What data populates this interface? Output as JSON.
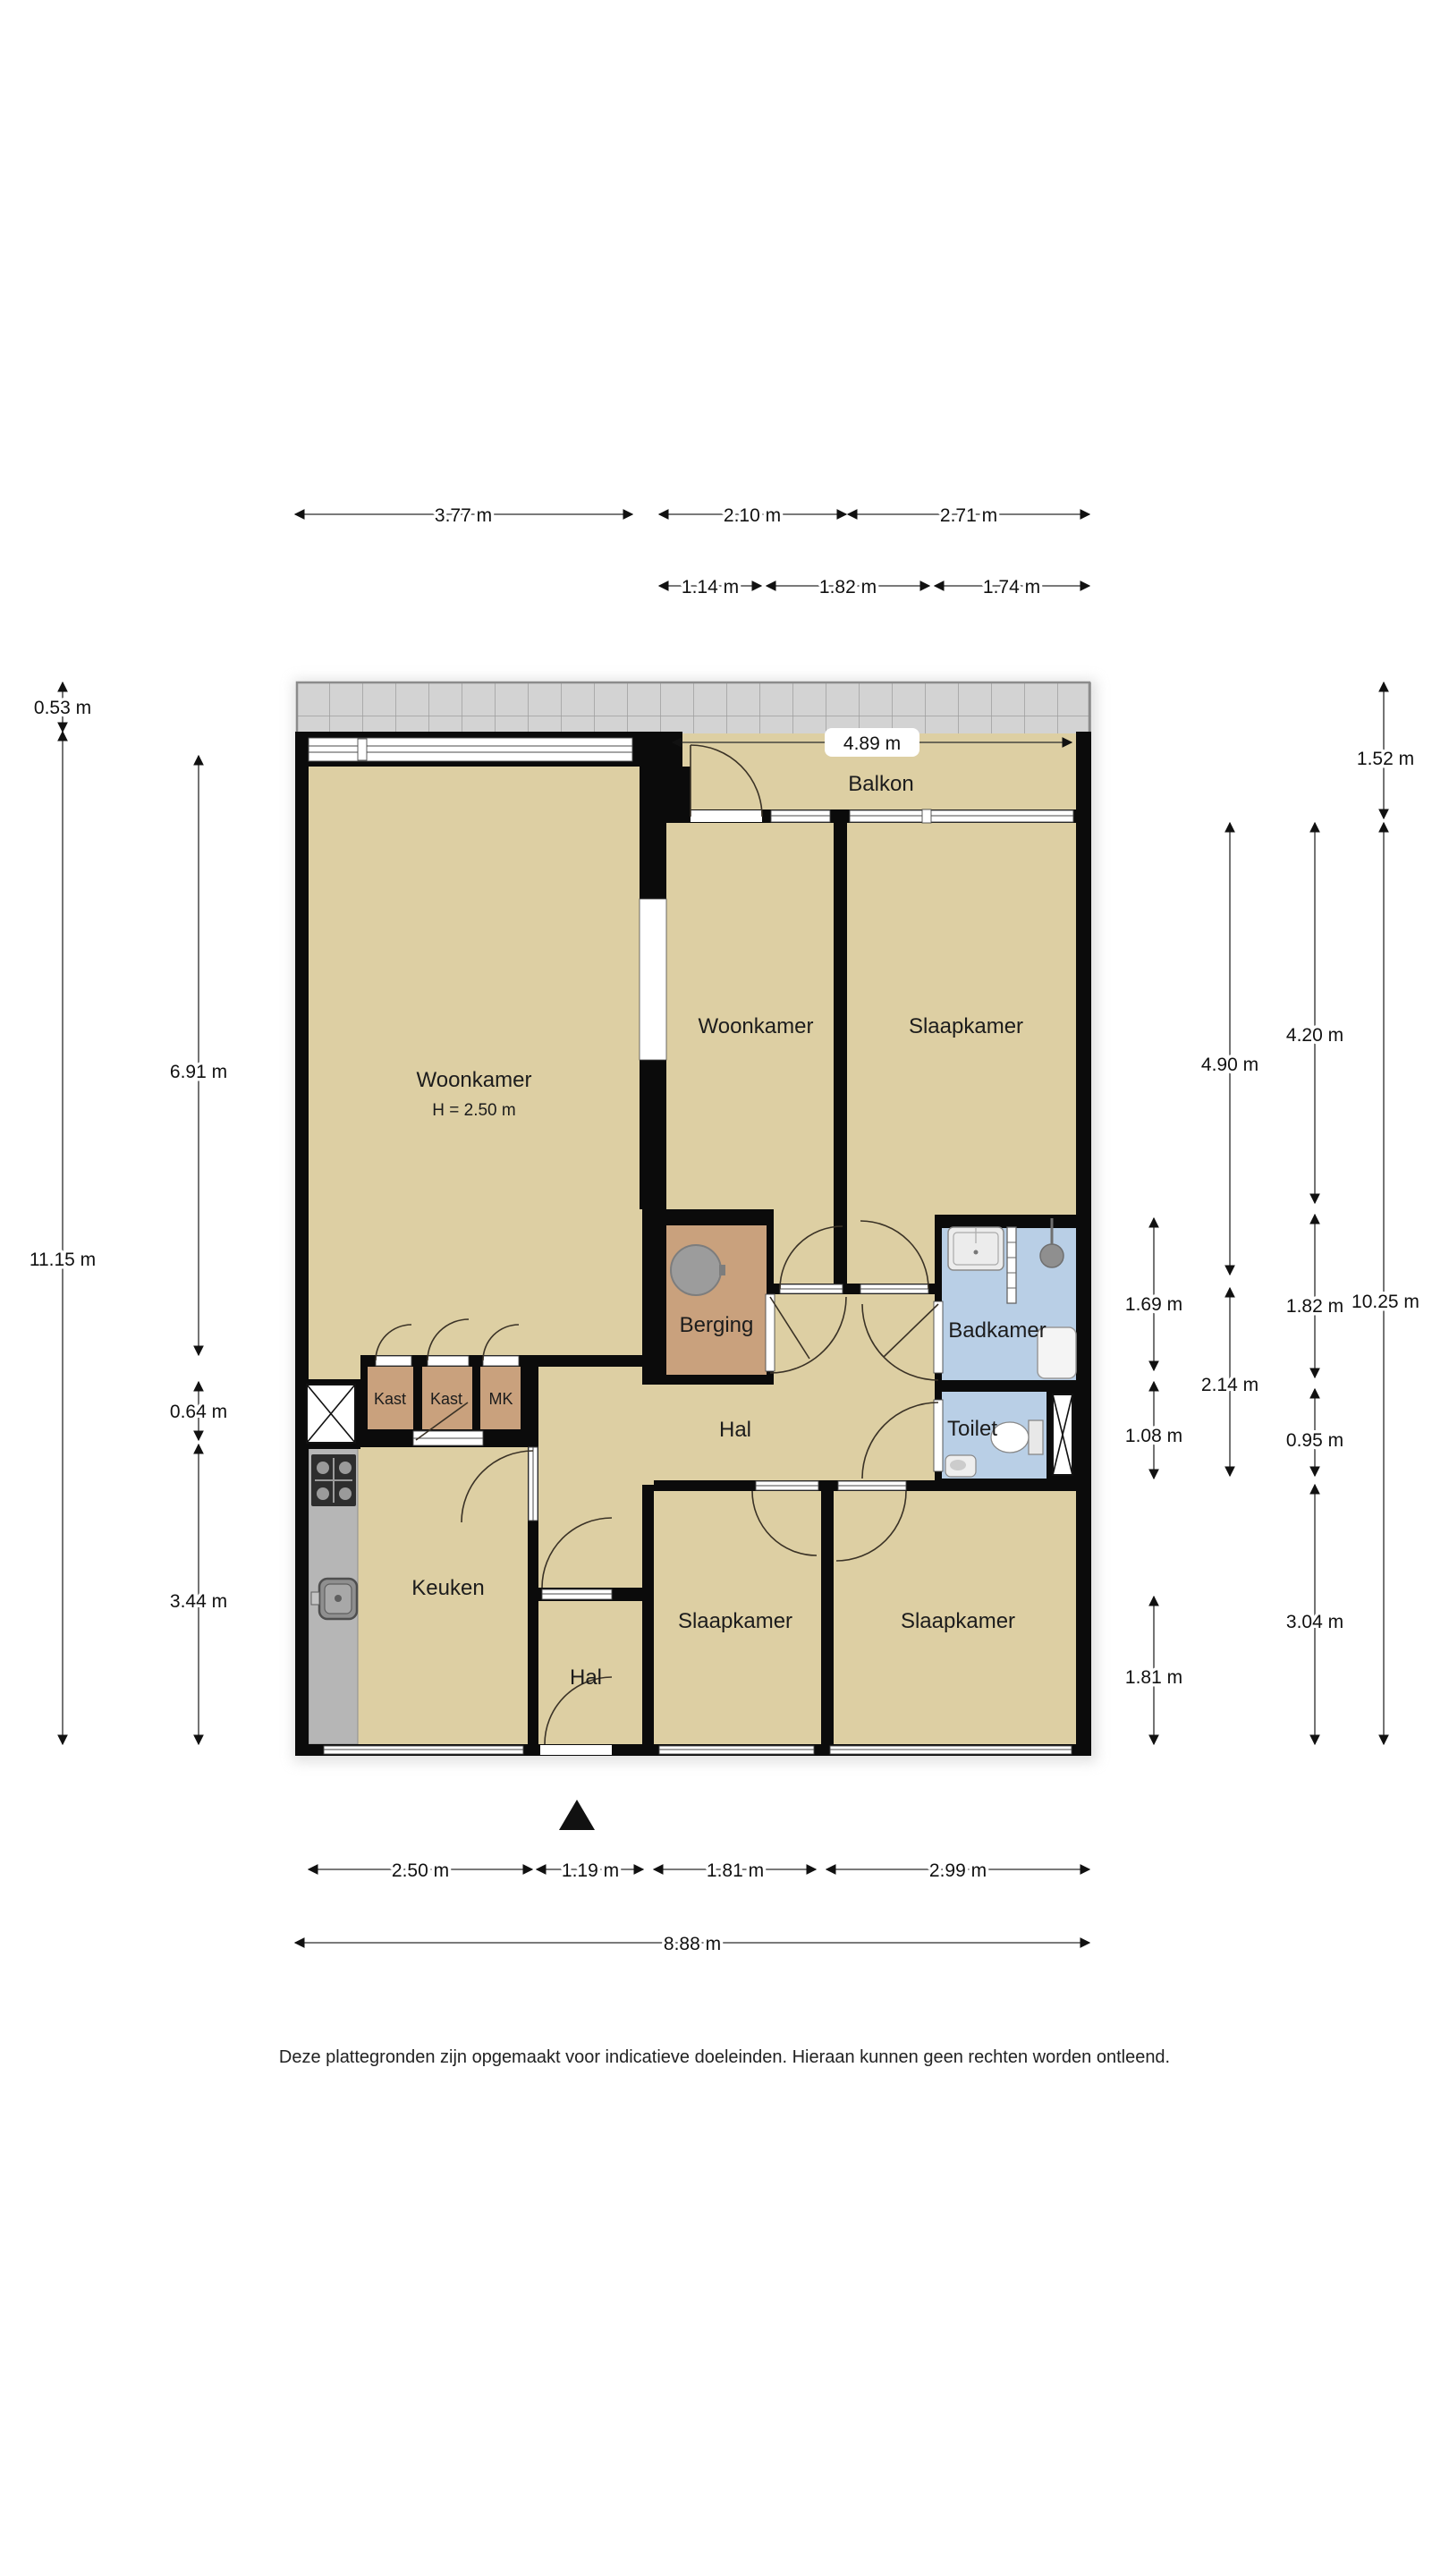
{
  "labels": {
    "balkon": "Balkon",
    "balkon_width": "4.89 m",
    "woonkamer_main": "Woonkamer",
    "woonkamer_main_height": "H = 2.50 m",
    "woonkamer_mid": "Woonkamer",
    "slaapkamer_top": "Slaapkamer",
    "berging": "Berging",
    "badkamer": "Badkamer",
    "toilet": "Toilet",
    "hal_main": "Hal",
    "kast1": "Kast",
    "kast2": "Kast",
    "mk": "MK",
    "keuken": "Keuken",
    "slaapkamer_bottom_left": "Slaapkamer",
    "slaapkamer_bottom_right": "Slaapkamer",
    "hal_entry": "Hal"
  },
  "dims": {
    "top_377": "3.77 m",
    "top_210": "2.10 m",
    "top_271": "2.71 m",
    "top_114": "1.14 m",
    "top_182": "1.82 m",
    "top_174": "1.74 m",
    "left_053": "0.53 m",
    "left_1115": "11.15 m",
    "left_691": "6.91 m",
    "left_064": "0.64 m",
    "left_344": "3.44 m",
    "right_152": "1.52 m",
    "right_420": "4.20 m",
    "right_490": "4.90 m",
    "right_169": "1.69 m",
    "right_182": "1.82 m",
    "right_1025": "10.25 m",
    "right_214": "2.14 m",
    "right_108": "1.08 m",
    "right_095": "0.95 m",
    "right_304": "3.04 m",
    "right_181": "1.81 m",
    "bottom_250": "2.50 m",
    "bottom_119": "1.19 m",
    "bottom_181": "1.81 m",
    "bottom_299": "2.99 m",
    "bottom_888": "8.88 m"
  },
  "footer": {
    "disclaimer": "Deze plattegronden zijn opgemaakt voor indicatieve doeleinden. Hieraan kunnen geen rechten worden ontleend."
  },
  "colors": {
    "floor": "#ddcfa3",
    "wet_floor": "#b9cfe6",
    "storage_floor": "#c9a17d",
    "wall": "#0b0b0b",
    "balcony_tile": "#d3d3d3",
    "balcony_grid": "#9e9e9e",
    "counter": "#b6b6b6"
  }
}
